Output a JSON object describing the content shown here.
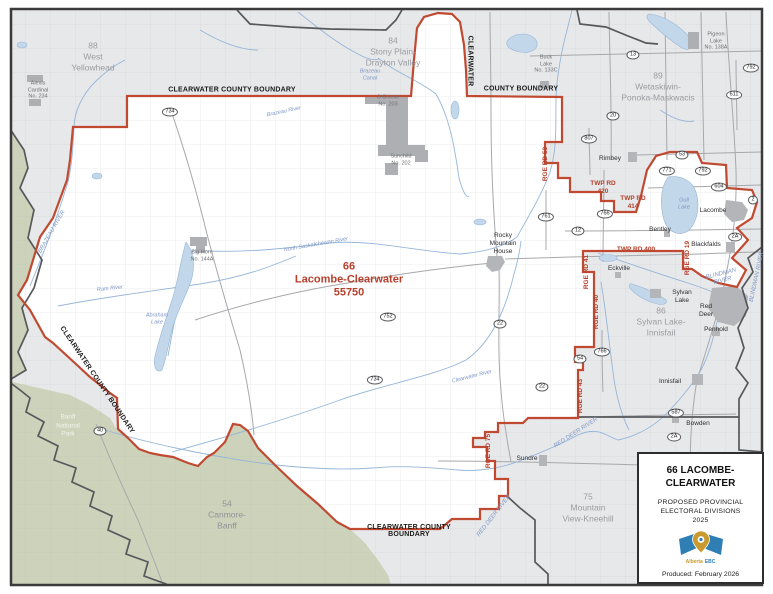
{
  "focal": {
    "number": "66",
    "name": "Lacombe-Clearwater",
    "population": "55750"
  },
  "neighbors": [
    {
      "lines": [
        "88",
        "West",
        "Yellowhead"
      ]
    },
    {
      "lines": [
        "84",
        "Stony Plain-",
        "Drayton Valley"
      ]
    },
    {
      "lines": [
        "89",
        "Wetaskiwin-",
        "Ponoka-Maskwacis"
      ]
    },
    {
      "lines": [
        "86",
        "Sylvan Lake-",
        "Innisfail"
      ]
    },
    {
      "lines": [
        "75",
        "Mountain",
        "View-Kneehill"
      ]
    },
    {
      "lines": [
        "54",
        "Canmore-",
        "Banff"
      ]
    }
  ],
  "boundaries": {
    "top": "CLEARWATER COUNTY BOUNDARY",
    "vertical_word": "CLEARWATER",
    "vertical_rest": "COUNTY  BOUNDARY",
    "diagonal": "CLEARWATER COUNTY BOUNDARY",
    "bottom1": "CLEARWATER COUNTY",
    "bottom2": "BOUNDARY"
  },
  "roads": {
    "twp420a": "TWP RD",
    "twp420b": "420",
    "twp414a": "TWP RD",
    "twp414b": "414",
    "twp400": "TWP RD 400",
    "rge53": "RGE RD 53",
    "rge41": "RGE RD 41",
    "rge40": "RGE RD 40",
    "rge43": "RGE RD 43",
    "rge19": "RGE RD 19",
    "rge75": "RGE RD 75"
  },
  "waters": {
    "brazeau": "BRAZEAU RIVER",
    "brazeau_small": "Brazeau River",
    "canal": [
      "Brazeau",
      "Canal"
    ],
    "nsask": "North Saskatchewan River",
    "ram": "Ram River",
    "abraham": [
      "Abraham",
      "Lake"
    ],
    "clearwater": "Clearwater River",
    "gull": [
      "Gull",
      "Lake"
    ],
    "blindman": [
      "BLINDMAN",
      "RIVER"
    ],
    "blindman_vert": "BLINDMAN RIVER",
    "reddeer_east": "RED DEER RIVER",
    "reddeer_south": "RED DEER RIVER"
  },
  "towns": {
    "rocky": [
      "Rocky",
      "Mountain",
      "House"
    ],
    "rimbey": "Rimbey",
    "lacombe": "Lacombe",
    "bentley": "Bentley",
    "blackfalds": "Blackfalds",
    "eckville": "Eckville",
    "sylvan": [
      "Sylvan",
      "Lake"
    ],
    "reddeer": [
      "Red",
      "Deer"
    ],
    "penhold": "Penhold",
    "innisfail": "Innisfail",
    "bowden": "Bowden",
    "sundre": "Sundre"
  },
  "reserves": {
    "alexis": [
      "Alexis",
      "Cardinal",
      "No. 234"
    ],
    "ochiese": [
      "O'Chiese",
      "No. 203"
    ],
    "sunchild": [
      "Sunchild",
      "No. 202"
    ],
    "bighorn": [
      "Big Horn",
      "No. 144A"
    ],
    "bucklake": [
      "Buck",
      "Lake",
      "No. 133C"
    ],
    "pigeonlake": [
      "Pigeon",
      "Lake",
      "No. 138A"
    ]
  },
  "park": [
    "Banff",
    "National",
    "Park"
  ],
  "shields": [
    "734",
    "13",
    "20",
    "611",
    "792",
    "807",
    "53",
    "771",
    "792",
    "604",
    "2",
    "761",
    "766",
    "12",
    "2A",
    "766",
    "54",
    "587",
    "2A",
    "22",
    "752",
    "734",
    "22",
    "40"
  ],
  "legend": {
    "title1": "66 LACOMBE-",
    "title2": "CLEARWATER",
    "sub1": "PROPOSED PROVINCIAL",
    "sub2": "ELECTORAL DIVISIONS",
    "sub3": "2025",
    "logo_word1": "Alberta",
    "logo_word2": "EBC",
    "produced": "Produced: February 2026"
  },
  "colors": {
    "boundary_red": "#c04a31",
    "label_red": "#b6402c",
    "other_boundary_gray": "#57585c",
    "outside_gray": "#e7e8ea",
    "park_green": "#cdd3bb",
    "water_fill": "#c3d7ea",
    "water_line": "#96b6d8",
    "urban_gray": "#b4b5b8",
    "neighbor_text": "#9b9ca1"
  }
}
